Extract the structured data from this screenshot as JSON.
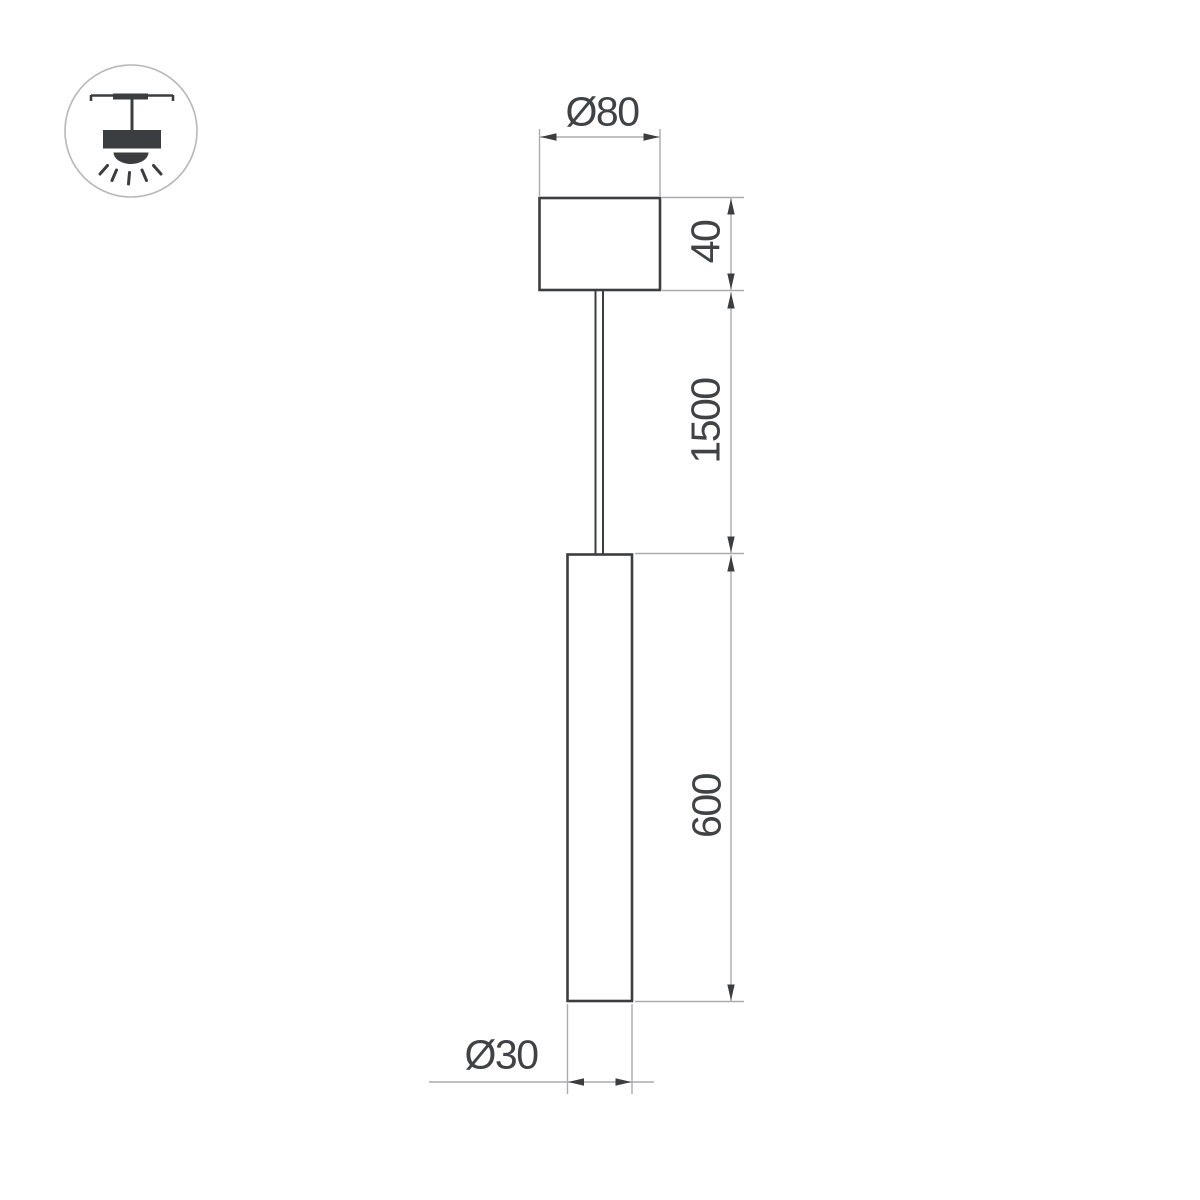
{
  "drawing": {
    "title": "pendant-lamp-dimension-drawing",
    "icon": {
      "name": "track-pendant-mount-icon"
    },
    "labels": {
      "canopy_diameter": "Ø80",
      "canopy_height": "40",
      "suspension_length": "1500",
      "body_length": "600",
      "body_diameter": "Ø30"
    },
    "colors": {
      "object_line": "#3b3e41",
      "dimension_line": "#a9abad",
      "text": "#404346",
      "icon_stroke": "#b5b7b9",
      "background": "#ffffff"
    }
  }
}
